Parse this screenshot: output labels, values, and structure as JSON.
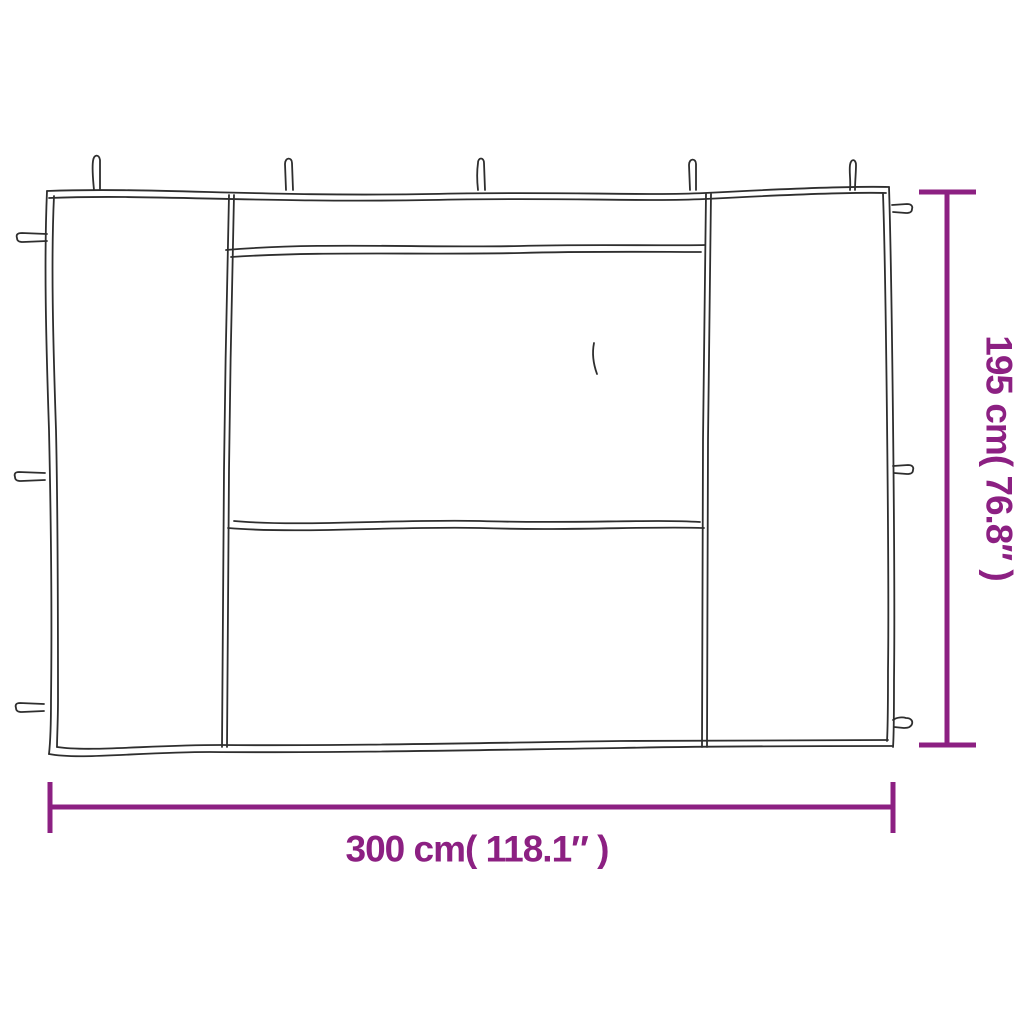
{
  "colors": {
    "background": "#FFFFFF",
    "line": "#2E2E2E",
    "accent": "#8C2082"
  },
  "dimensions": {
    "width_label": "300 cm( 118.1″ )",
    "height_label": "195 cm( 76.8″ )"
  },
  "diagram": {
    "subject": "gazebo sidewall with window",
    "top_tie_count": 5,
    "left_tab_count": 3,
    "right_tab_count": 3
  }
}
